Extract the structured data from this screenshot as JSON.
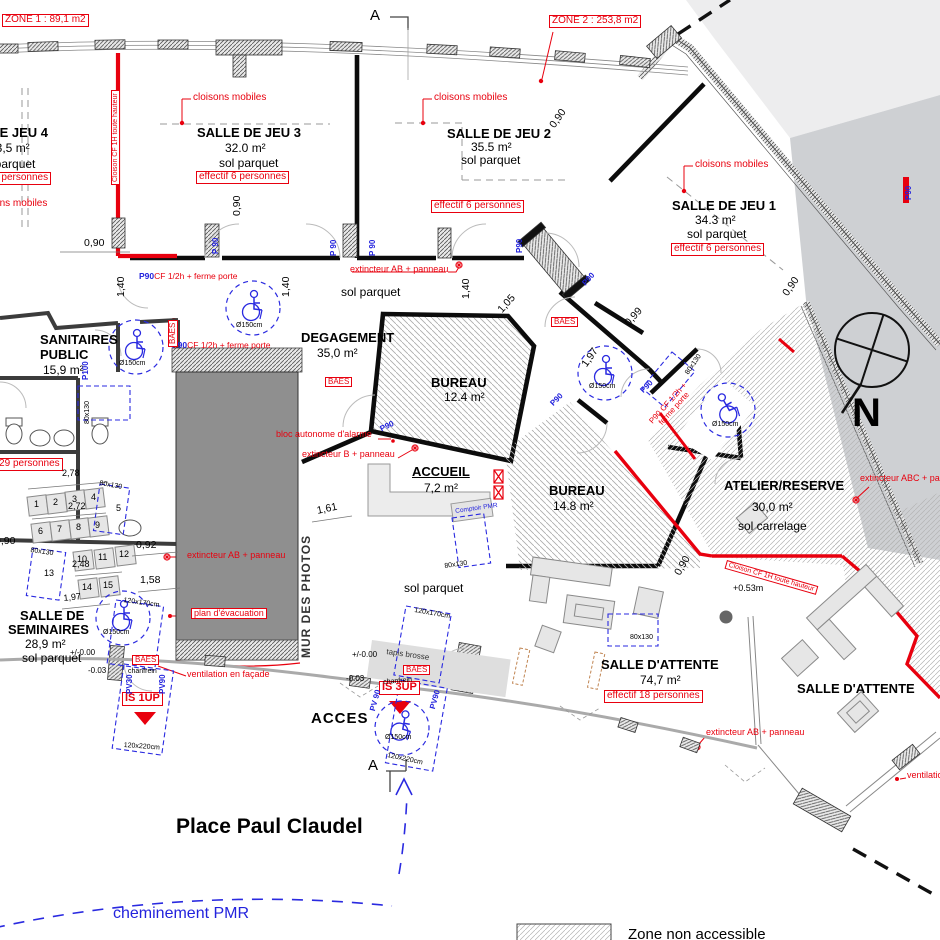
{
  "zones": {
    "zone1": "ZONE 1 : 89,1 m2",
    "zone2": "ZONE 2 : 253,8  m2"
  },
  "rooms": {
    "jeu4": {
      "title": "SALLE DE JEU 4",
      "area": "33,5 m²",
      "floor": "sol parquet",
      "eff": "effectif 6 personnes"
    },
    "jeu3": {
      "title": "SALLE DE JEU 3",
      "area": "32.0 m²",
      "floor": "sol parquet",
      "eff": "effectif 6 personnes"
    },
    "jeu2": {
      "title": "SALLE DE JEU 2",
      "area": "35.5 m²",
      "floor": "sol parquet",
      "eff": "effectif 6 personnes"
    },
    "jeu1": {
      "title": "SALLE DE JEU 1",
      "area": "34.3 m²",
      "floor": "sol parquet",
      "eff": "effectif 6 personnes"
    },
    "sanitaires": {
      "title1": "SANITAIRES",
      "title2": "PUBLIC",
      "area": "15,9 m²"
    },
    "degagement": {
      "title": "DEGAGEMENT",
      "area": "35,0 m²",
      "floor": "sol parquet"
    },
    "bureau1": {
      "title": "BUREAU",
      "area": "12.4 m²"
    },
    "accueil": {
      "title": "ACCUEIL",
      "area": "7,2 m²"
    },
    "bureau2": {
      "title": "BUREAU",
      "area": "14.8  m²"
    },
    "atelier": {
      "title": "ATELIER/RESERVE",
      "area": "30,0 m²",
      "floor": "sol carrelage"
    },
    "seminaires": {
      "title1": "SALLE DE",
      "title2": "SEMINAIRES",
      "area": "28,9 m²",
      "floor": "sol parquet",
      "eff": "effectif 29 personnes"
    },
    "attente1": {
      "title": "SALLE D'ATTENTE",
      "area": "74,7 m²",
      "eff": "effectif 18 personnes"
    },
    "attente2": {
      "title": "SALLE D'ATTENTE"
    },
    "acces": {
      "title": "ACCES"
    }
  },
  "annotations": {
    "cloisons_mobiles": "cloisons mobiles",
    "cloison_cf": "Cloison CF 1H toute hauteur",
    "cf_ferme": "CF 1/2h + ferme porte",
    "p90cf_rot1": "P90 CF 1/2h +",
    "p90cf_rot2": "ferme porte",
    "baes": "BAES",
    "ext_ab": "extincteur AB + panneau",
    "ext_b": "extincteur B + panneau",
    "ext_abc": "extincteur ABC + panneau",
    "bloc_alarme": "bloc autonome d'alarme",
    "plan_evac": "plan d'évacuation",
    "ventilation": "ventilation en façade",
    "is1up": "IS 1UP",
    "is3up": "IS 3UP",
    "tapis": "tapis brosse",
    "chanfrein": "chanfrein",
    "comptoir": "Comptoir PMR",
    "mur_photos": "MUR DES PHOTOS",
    "north": "N",
    "section": "A",
    "place": "Place Paul Claudel",
    "chem_pmr": "cheminement PMR",
    "legend_zone": "Zone non accessible"
  },
  "dims": {
    "d090": "0,90",
    "d092": "0,92",
    "d158": "1,58",
    "d278": "2,78",
    "d272": "2,72",
    "d248": "2,48",
    "d197": "1,97",
    "d140": "1,40",
    "d105": "1,05",
    "d099": "0,99",
    "d161": "1,61",
    "lvl0": "+/-0.00",
    "lvlm03": "-0.03",
    "lvl053": "+0.53m"
  },
  "doors": {
    "p90s": "P 90",
    "p90": "P90",
    "p100": "P100",
    "pv30": "PV30",
    "pv90": "PV90",
    "pv90s": "PV 90"
  },
  "sizes": {
    "s80": "80x130",
    "s120170": "120x170cm",
    "s120220": "120x220cm",
    "d150": "Ø150cm"
  },
  "seats": [
    "1",
    "2",
    "3",
    "4",
    "5",
    "6",
    "7",
    "8",
    "9",
    "10",
    "11",
    "12",
    "13",
    "14",
    "15"
  ],
  "colors": {
    "annotation_red": "#e8000e",
    "annotation_blue": "#2222dd",
    "wall_black": "#0c0c0c",
    "mur_gray": "#8f8f8f"
  }
}
